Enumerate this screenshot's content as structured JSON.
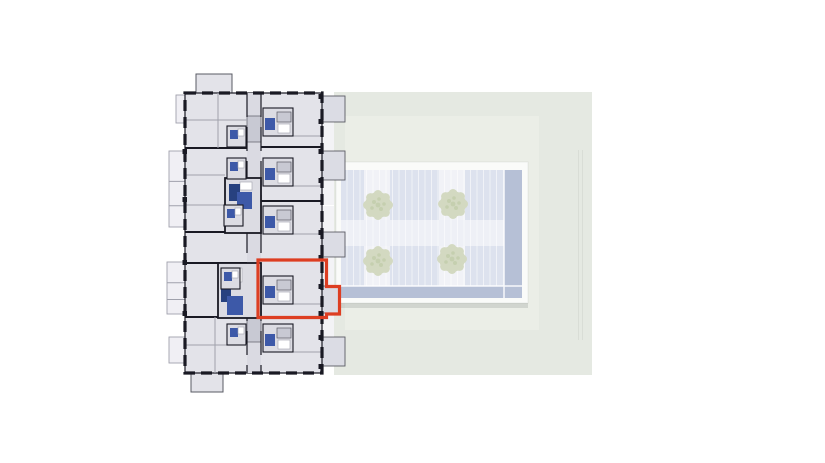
{
  "colors": {
    "white": "#ffffff",
    "siteGreen": "#e5e9e2",
    "siteGreenLight": "#ebeee7",
    "plazaFrame": "#fafbf9",
    "pavingBase": "#dde2ee",
    "pavingLight": "#f1f2f7",
    "pavingBand": "#eef0f6",
    "jointWhite": "rgba(255,255,255,0.55)",
    "poolBand": "#b6c0d6",
    "plazaShadow": "rgba(130,140,135,0.25)",
    "treeFill": "#d3d9c1",
    "treeDark": "#bfcaa7",
    "bldgFill": "#e3e3e9",
    "bldgFillDark": "#dcdce3",
    "corridorFill": "#dadae2",
    "serviceGrey": "#c8c9d3",
    "balconyGrey": "#dbdce4",
    "terracePale": "#f3f3f6",
    "leftBalconyPale": "#f0eff4",
    "wallDark": "#191923",
    "wallMid": "#5a5b64",
    "lineThin": "#a0a1ac",
    "blue": "#3d59a8",
    "blueDark": "#27417f",
    "fixtureWhite": "#ffffff",
    "highlight": "#dd3e22"
  },
  "geometry": {
    "site": {
      "x": 334,
      "y": 92,
      "w": 258,
      "h": 283
    },
    "siteInner": {
      "x": 345,
      "y": 116,
      "w": 194,
      "h": 214
    },
    "faintLines": [
      578.5,
      582.5
    ],
    "plaza": {
      "x": 336,
      "y": 162,
      "w": 192,
      "h": 141
    },
    "paving": {
      "x": 341,
      "y": 170,
      "w": 181,
      "h": 128
    },
    "lightCols": [
      364,
      439
    ],
    "midBand": {
      "y": 220,
      "h": 26
    },
    "poolRight": {
      "x": 504,
      "y": 170,
      "w": 18,
      "h": 128
    },
    "poolBottom": {
      "x": 341,
      "y": 286,
      "w": 181,
      "h": 12
    },
    "shadow": {
      "x": 336,
      "y": 303,
      "w": 192,
      "h": 5
    },
    "trees": [
      {
        "x": 378,
        "y": 205
      },
      {
        "x": 453,
        "y": 204
      },
      {
        "x": 378,
        "y": 261
      },
      {
        "x": 452,
        "y": 259
      }
    ],
    "building": {
      "x": 185,
      "y": 93,
      "w": 137,
      "h": 280
    },
    "corridor": {
      "x": 247,
      "y": 93,
      "w": 14,
      "h": 280
    },
    "topBump": {
      "x": 196,
      "y": 74,
      "w": 36,
      "h": 19
    },
    "bottomBump": {
      "x": 191,
      "y": 373,
      "w": 32,
      "h": 19
    },
    "leftBalconies": [
      {
        "x": 169,
        "y": 151,
        "w": 17,
        "h": 76
      },
      {
        "x": 167,
        "y": 262,
        "w": 19,
        "h": 52
      },
      {
        "x": 169,
        "y": 337,
        "w": 17,
        "h": 26
      },
      {
        "x": 176,
        "y": 95,
        "w": 9,
        "h": 28
      }
    ],
    "rightBalconies": [
      {
        "y": 96,
        "h": 26,
        "w": 23
      },
      {
        "y": 151,
        "h": 29,
        "w": 23
      },
      {
        "y": 232,
        "h": 25,
        "w": 23
      },
      {
        "y": 286,
        "h": 27,
        "w": 18
      },
      {
        "y": 337,
        "h": 29,
        "w": 23
      }
    ],
    "terraces": [
      {
        "y": 123,
        "h": 27
      },
      {
        "y": 181,
        "h": 24
      },
      {
        "y": 206,
        "h": 25
      },
      {
        "y": 258,
        "h": 27
      },
      {
        "y": 314,
        "h": 22
      }
    ],
    "dividersLeft": [
      148,
      232,
      263,
      317
    ],
    "dividersRight": [
      147,
      201,
      260,
      318
    ],
    "serviceBlocks": [
      {
        "y": 116,
        "h": 26
      },
      {
        "y": 200,
        "h": 22
      },
      {
        "y": 318,
        "h": 24
      }
    ],
    "rightBaths": [
      108,
      158,
      206,
      276,
      324
    ],
    "leftBaths": [
      {
        "x": 227,
        "y": 126
      },
      {
        "x": 227,
        "y": 158
      },
      {
        "x": 224,
        "y": 205
      },
      {
        "x": 221,
        "y": 268
      },
      {
        "x": 227,
        "y": 324
      }
    ],
    "ticksRight": [
      94,
      119,
      149,
      178,
      230,
      255,
      284,
      311,
      335,
      364
    ],
    "ticksLeft": [
      149,
      197,
      260,
      311
    ],
    "thinLines": [
      "M185,120 H247",
      "M218,93 V148",
      "M185,175 H225",
      "M215,317 V373",
      "M185,345 H247",
      "M185,205 H225"
    ],
    "selectedOutline": "M258,260 H326.5 V286.5 H339.5 V314 H326.5 V317.5 H258 Z"
  }
}
